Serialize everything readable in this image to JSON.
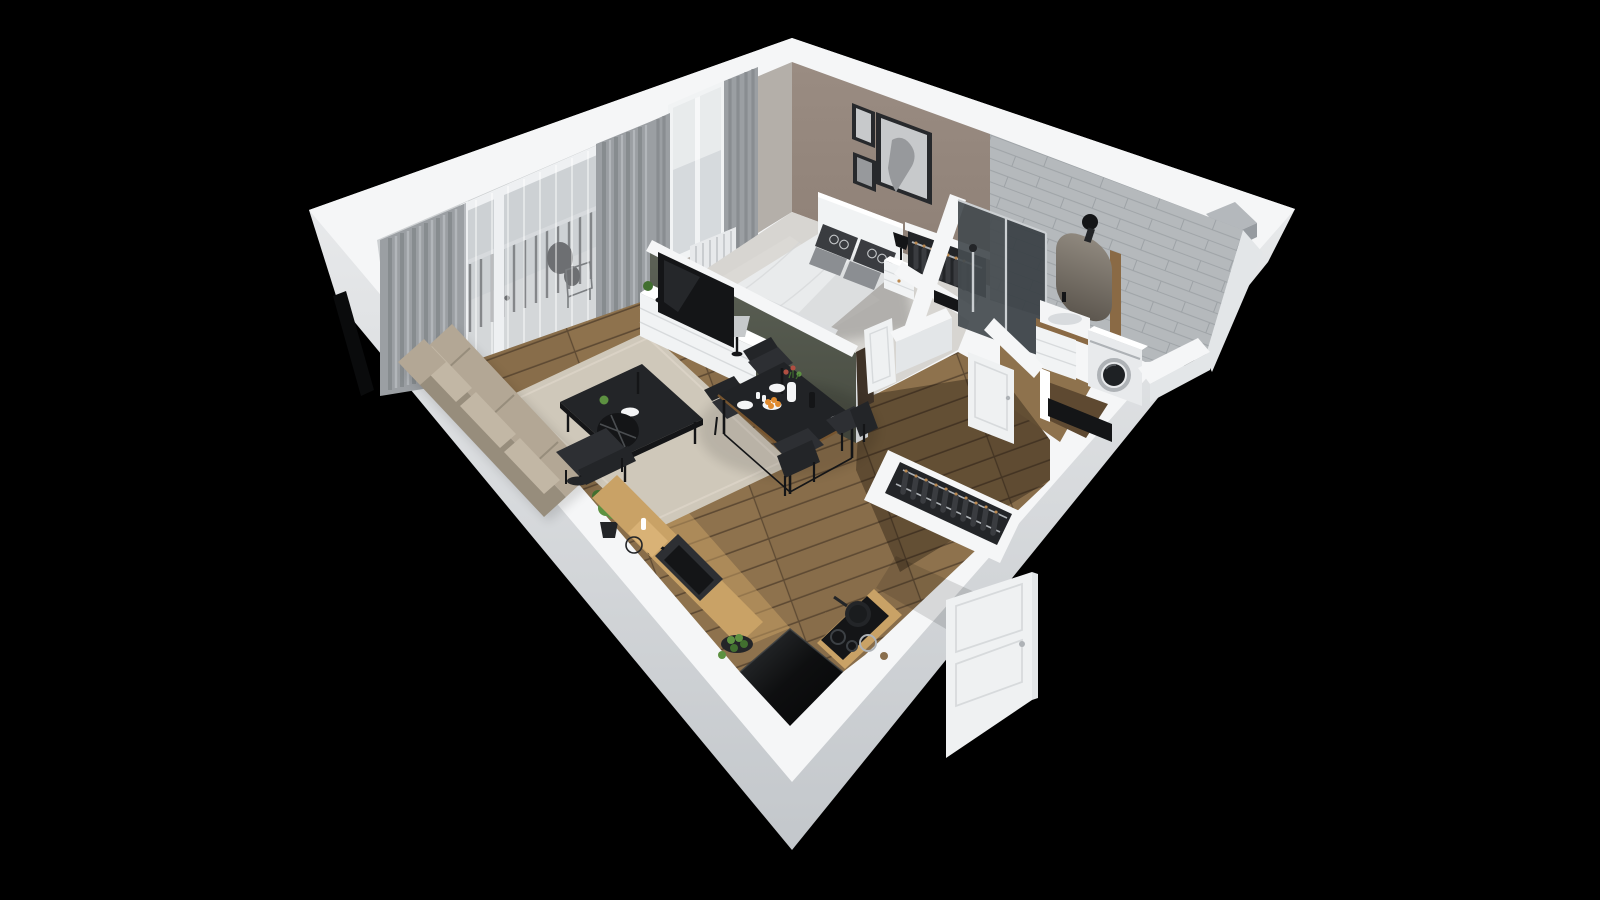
{
  "scene": {
    "type": "3d-floorplan-render",
    "description": "Isometric 3D cutaway render of a one-bedroom apartment viewed from above on a black background",
    "view": "axonometric, apartment corner pointing down",
    "rooms": {
      "living_room": {
        "furniture": [
          "sofa",
          "rug",
          "coffee-table",
          "arc-floor-lamp",
          "armchair",
          "plant",
          "tv-sideboard",
          "tv",
          "table-lamp",
          "curtains",
          "balcony-with-railing"
        ]
      },
      "bedroom": {
        "furniture": [
          "double-bed",
          "headboard",
          "pillows",
          "nightstand",
          "bedside-lamp",
          "open-wardrobe",
          "window-with-curtains",
          "radiator",
          "wall-art"
        ]
      },
      "bathroom": {
        "furniture": [
          "walk-in-shower",
          "mirror",
          "wall-sconce",
          "washbasin-cabinet",
          "washing-machine",
          "tiled-walls"
        ]
      },
      "kitchen": {
        "furniture": [
          "wood-counter",
          "black-sink",
          "cutting-board",
          "fruit-plate",
          "cooktop",
          "pans",
          "black-island"
        ]
      },
      "dining_area": {
        "furniture": [
          "black-table",
          "four-chairs",
          "plates",
          "vase-with-flowers",
          "bowl-of-oranges"
        ]
      },
      "hallway": {
        "furniture": [
          "open-closet-with-clothes",
          "entrance-door",
          "bathroom-door",
          "bedroom-door"
        ]
      }
    }
  },
  "palette": {
    "bg": "#000000",
    "extTop": "#f1f2f3",
    "extBottom": "#c3c7cb",
    "wallTop": "#f5f6f7",
    "wallFaceLight": "#e3e6e8",
    "windowSliver": "#0a0b0c",
    "ventShadow": "#b4b8bc",
    "ventFace": "#969ba0",
    "curtainBase": "#cdd0d2",
    "bedroomWall": "#b4afa9",
    "curtain": "#9b9fa3",
    "curtainDark": "#84888c",
    "curtainLight": "#b8bcbf",
    "sheer": "#e8ebec",
    "glass": "#bdc2c6",
    "railBar": "#393c3f",
    "railTop": "#cdd1d4",
    "balconyFloor": "#c8cbcd",
    "mullion": "#f2f4f5",
    "radiator": "#e7e9eb",
    "radiatorFin": "#c9cccf",
    "sage": "#5d6257",
    "sageDark": "#474b40",
    "taupe": "#8d7f75",
    "taupeLight": "#9a8c82",
    "frameDark": "#27292c",
    "artPaper": "#c7c9cb",
    "artInk": "#97999c",
    "tile": "#b5b9bc",
    "tileLine": "#9da2a6",
    "showerGlass": "#454b50",
    "showerGlassFront": "#394045",
    "glassEdge": "#ccd0d3",
    "chrome": "#c9cdd0",
    "mirror": "#6f6960",
    "woodSlat": "#8a6a45",
    "floorWood": "#8e724d",
    "floorWoodDark": "#7b6142",
    "plankGap": "#5e4a33",
    "kitchenWood": "#c9a266",
    "hallShade": "rgba(18,12,6,0.34)",
    "rug": "#cfc8ba",
    "rugLight": "#dad3c6",
    "carpet": "#d7d5d1",
    "white": "#f1f3f4",
    "duvet": "#e9ebec",
    "duvetShade": "#d2d4d6",
    "foldLight": "#dcdee0",
    "pillowDark": "#3a3c40",
    "pillowGray": "#8b8e92",
    "patternDot": "#d3d5d7",
    "sofa": "#b3a795",
    "sofaLight": "#c2b7a5",
    "sofaDark": "#978d7c",
    "black": "#141517",
    "charcoal": "#232528",
    "chairDark": "#2d2f33",
    "tableTop": "#212326",
    "tableEdge": "#77552f",
    "plateWhite": "#f4f5f6",
    "orange": "#e08a2e",
    "red": "#b04f42",
    "green": "#5d9141",
    "greenDark": "#416f2f",
    "hanger": "#bb8950",
    "doorWhite": "#eff1f2",
    "doorLine": "#d7dadc",
    "doorDarkGap": "#3e3227",
    "entryFloorDark": "#5e4931",
    "machine": "#e8eaec",
    "machineDoor": "#1e2124",
    "ringGray": "#aeb2b6",
    "sinkShadow": "#d8dbde",
    "lampShade": "#c6c9cb",
    "burner": "#3c4044",
    "islandHi": "#303336",
    "shadow": "rgba(0,0,0,0.35)",
    "lightPatch": "rgba(255,255,255,0.10)"
  }
}
